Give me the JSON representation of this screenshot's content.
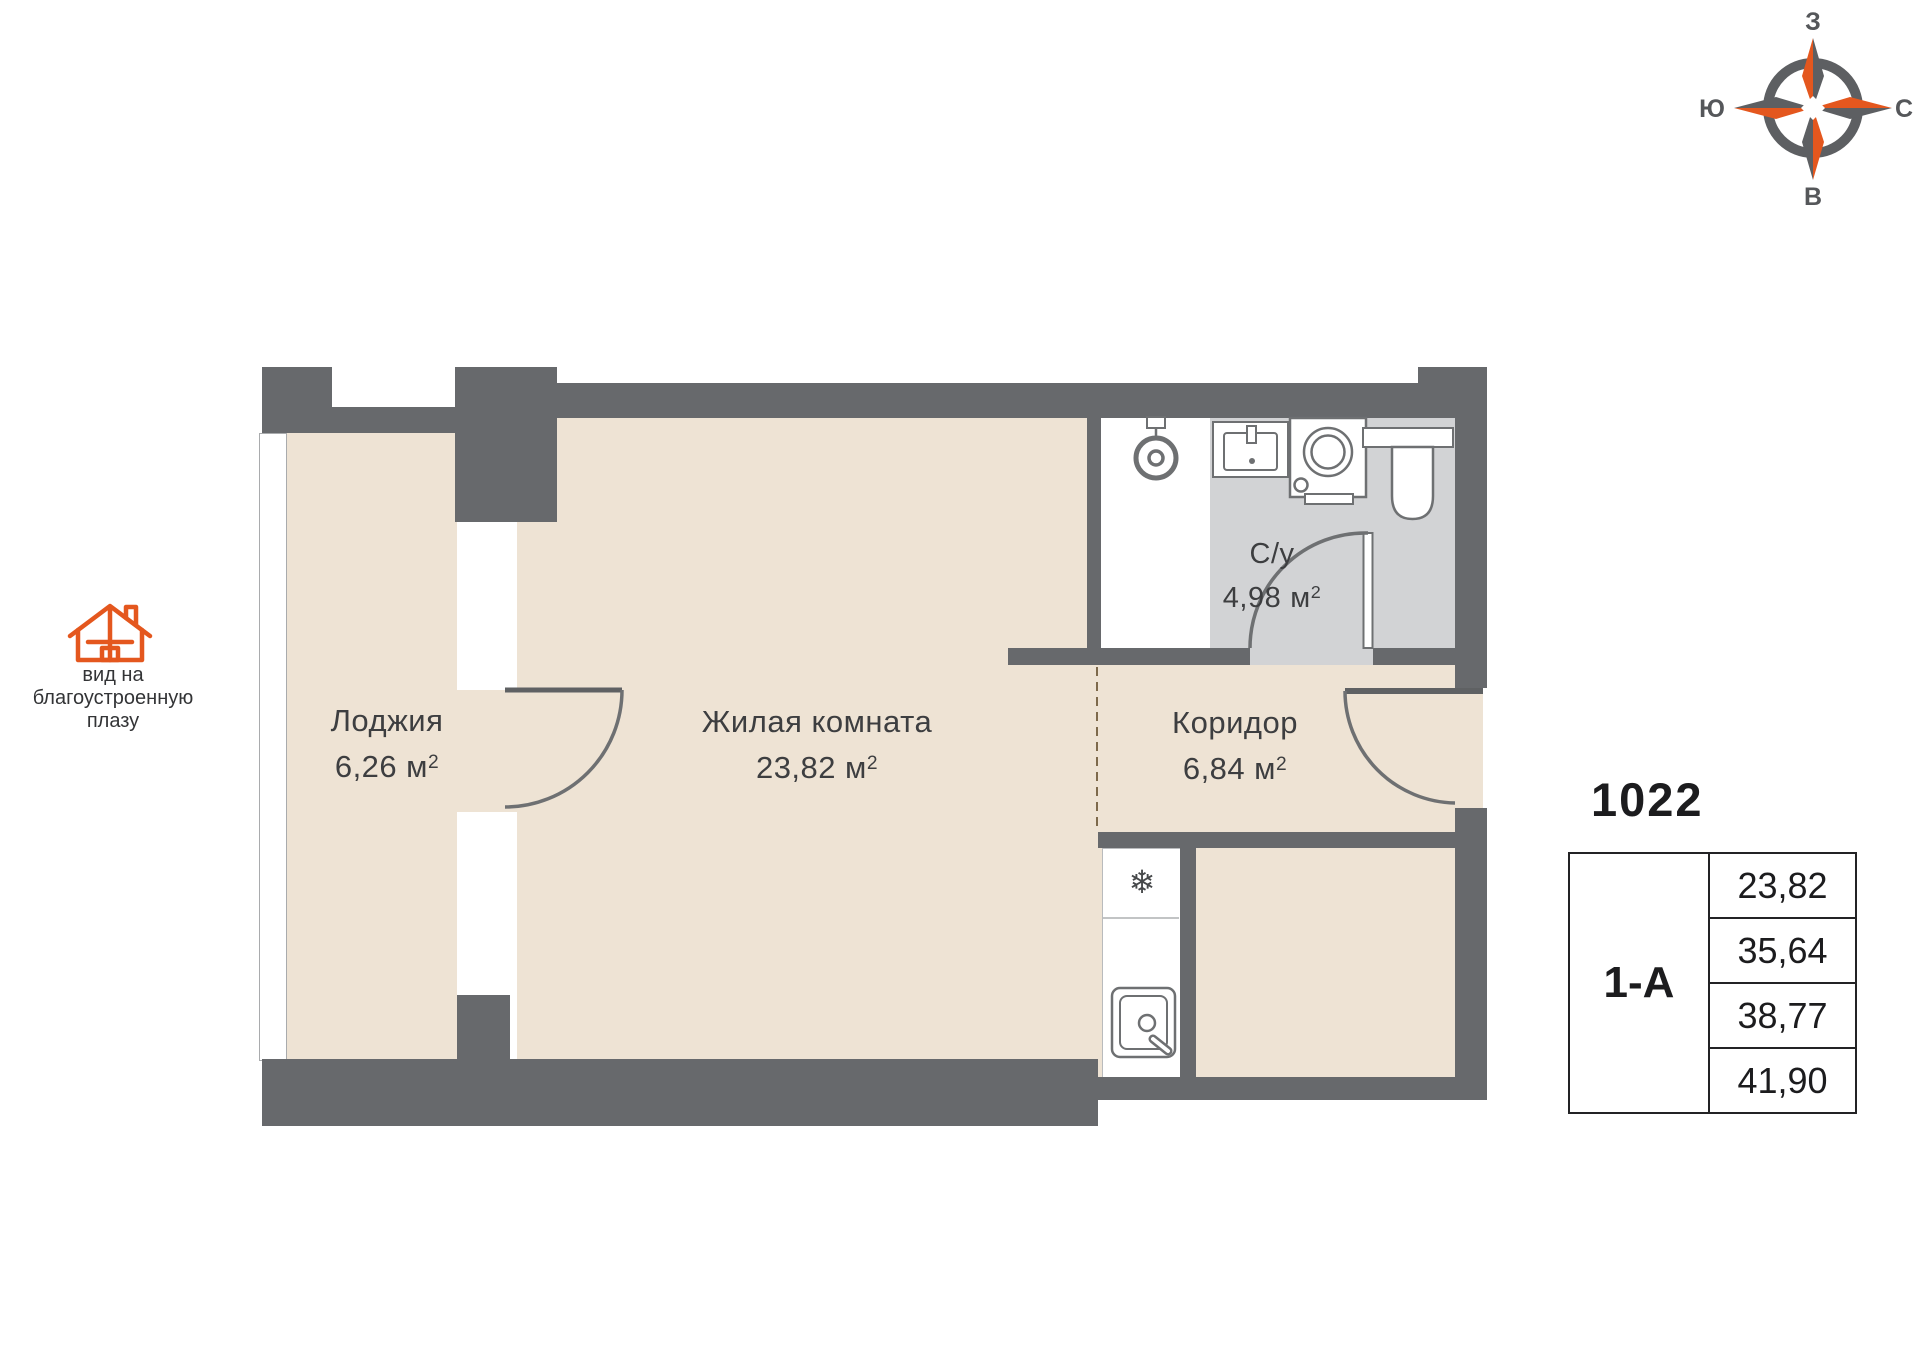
{
  "colors": {
    "wall": "#67696c",
    "floor": "#eee3d4",
    "wet_floor": "#d2d3d5",
    "accent_orange": "#e4571e",
    "line": "#6e7072",
    "dash": "#7d694b",
    "text_dark": "#1c1c1e",
    "label_text": "#3d3e40"
  },
  "compass": {
    "west": "З",
    "north": "С",
    "south": "Ю",
    "east": "В"
  },
  "view_note": {
    "line1": "вид на",
    "line2": "благоустроенную",
    "line3": "плазу"
  },
  "unit": {
    "base": "м",
    "exp": "2"
  },
  "rooms": {
    "loggia": {
      "name": "Лоджия",
      "area": "6,26"
    },
    "living": {
      "name": "Жилая комната",
      "area": "23,82"
    },
    "bathroom": {
      "name": "С/у",
      "area": "4,98"
    },
    "corridor": {
      "name": "Коридор",
      "area": "6,84"
    }
  },
  "info_panel": {
    "unit_number": "1022",
    "plan_type": "1-А",
    "areas": [
      "23,82",
      "35,64",
      "38,77",
      "41,90"
    ]
  },
  "icons": {
    "snowflake": "❄"
  }
}
